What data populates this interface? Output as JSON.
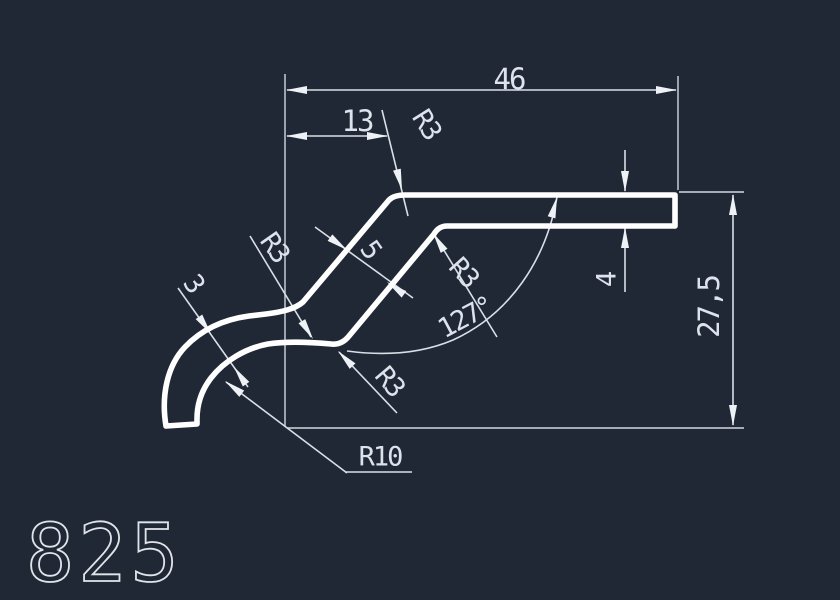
{
  "drawing": {
    "part_number": "825",
    "colors": {
      "background": "#212835",
      "profile_line": "#ffffff",
      "dimension_line": "#d9dfe8",
      "text": "#dde3ec"
    },
    "dims": {
      "total_width": "46",
      "offset_width": "13",
      "fillet_top": "R3",
      "fillet_left": "R3",
      "fillet_inner": "R3",
      "fillet_bottom": "R3",
      "hook_thickness": "3",
      "web_thickness": "5",
      "flange_thickness": "4",
      "total_height": "27,5",
      "bend_angle": "127°",
      "hook_radius": "R10"
    }
  }
}
